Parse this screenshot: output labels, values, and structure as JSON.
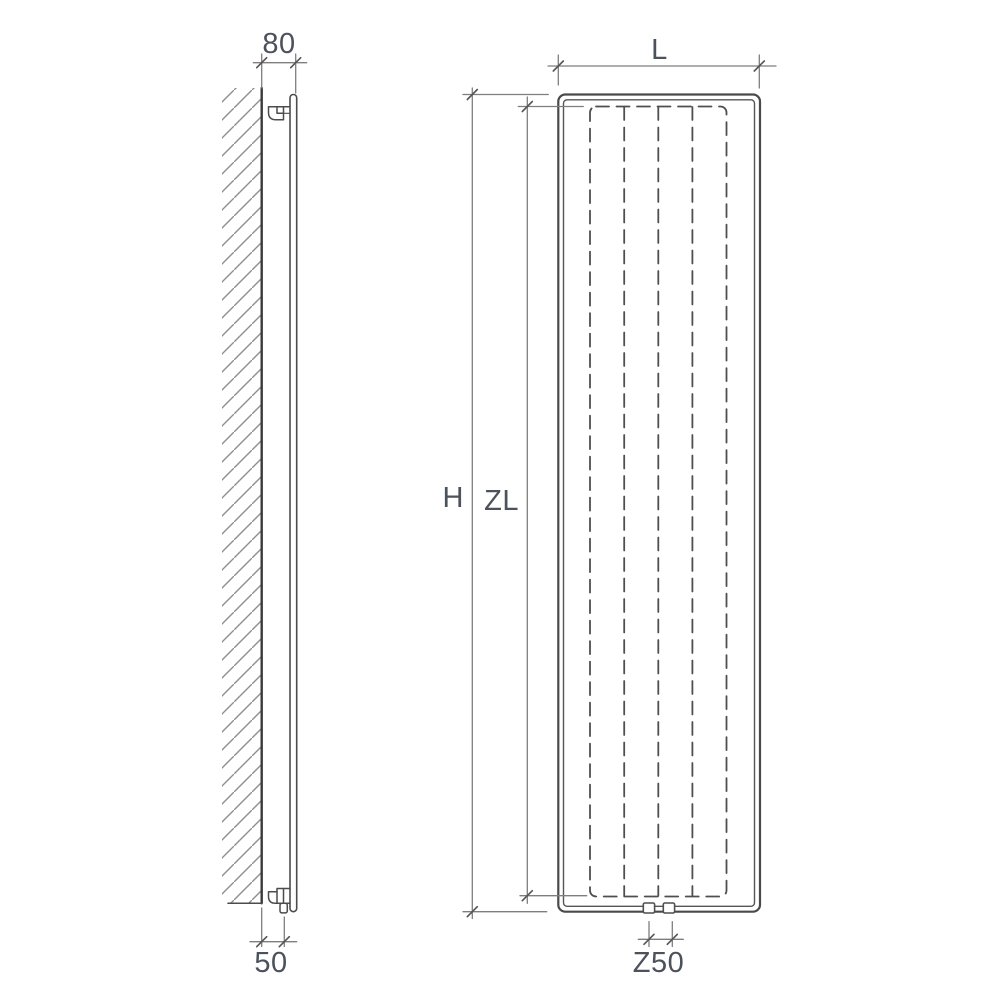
{
  "diagram": {
    "title": "radiator installation dimension drawing",
    "colors": {
      "background": "#ffffff",
      "object_line": "#4c4c4c",
      "dimension_line": "#7e7e7e",
      "wall_line": "#333333",
      "hatch_line": "#8f8f8f",
      "label_text": "#4b525b"
    },
    "side_view": {
      "description": "wall-mounted radiator side profile with brackets and bottom pipe",
      "labels": {
        "wall_to_front_depth": "80",
        "wall_to_pipe_depth": "50"
      }
    },
    "front_view": {
      "description": "vertical radiator front view with dashed convector fins and bottom connections",
      "fin_count": 5,
      "labels": {
        "width": "L",
        "overall_height": "H",
        "convector_height": "ZL",
        "connection_spacing": "Z50"
      }
    }
  }
}
